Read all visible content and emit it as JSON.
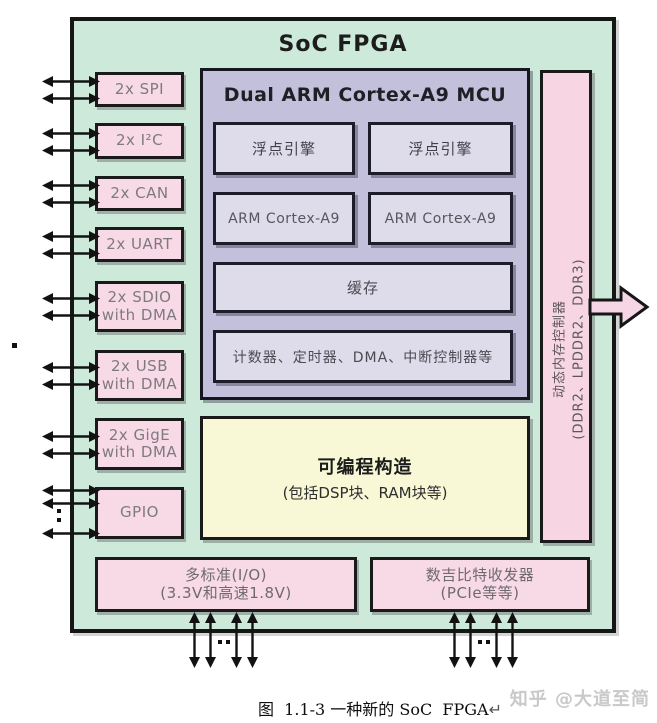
{
  "title": "SoC FPGA",
  "peripherals": [
    {
      "line1": "2x SPI"
    },
    {
      "line1": "2x I²C"
    },
    {
      "line1": "2x CAN"
    },
    {
      "line1": "2x UART"
    },
    {
      "line1": "2x SDIO",
      "line2": "with DMA"
    },
    {
      "line1": "2x USB",
      "line2": "with DMA"
    },
    {
      "line1": "2x GigE",
      "line2": "with DMA"
    },
    {
      "line1": "GPIO"
    }
  ],
  "mcu": {
    "title": "Dual ARM Cortex-A9 MCU",
    "fp_left": "浮点引擎",
    "fp_right": "浮点引擎",
    "core_left": "ARM Cortex-A9",
    "core_right": "ARM Cortex-A9",
    "cache": "缓存",
    "misc": "计数器、定时器、DMA、中断控制器等"
  },
  "fabric": {
    "title": "可编程构造",
    "subtitle": "(包括DSP块、RAM块等)"
  },
  "memory_controller": {
    "name": "动态内存控制器",
    "types": "(DDR2、LPDDR2、DDR3)"
  },
  "io_bank": {
    "line1": "多标准(I/O)",
    "line2": "(3.3V和高速1.8V)"
  },
  "transceiver_bank": {
    "line1": "数吉比特收发器",
    "line2": "(PCIe等等)"
  },
  "caption": {
    "text": "图  1.1-3 一种新的 SoC  FPGA",
    "return_mark": "↵"
  },
  "watermark": "知乎 @大道至简",
  "colors": {
    "board_green": "#cde9da",
    "block_pink": "#f8d9e6",
    "mcu_purple": "#c2c0da",
    "mcu_inner_lavender": "#dedcea",
    "fabric_yellow": "#f8f7d6",
    "border_black": "#1a1a1a"
  }
}
